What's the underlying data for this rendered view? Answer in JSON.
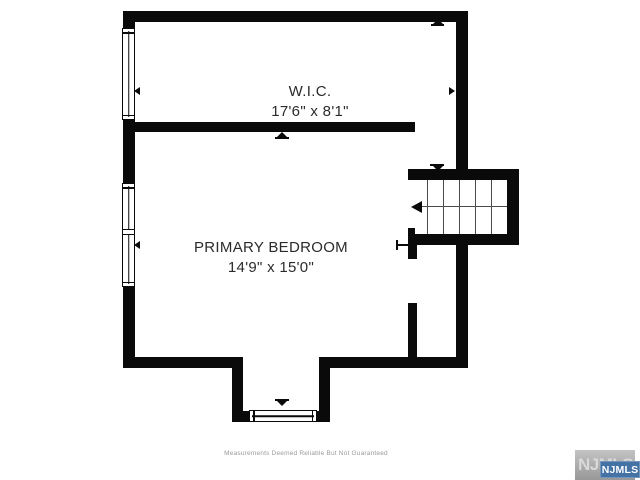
{
  "floorplan": {
    "rooms": [
      {
        "name": "W.I.C.",
        "dimensions": "17'6\" x 8'1\""
      },
      {
        "name": "PRIMARY BEDROOM",
        "dimensions": "14'9\" x 15'0\""
      }
    ],
    "stairs": {
      "tread_count": 6,
      "direction_arrow": "left"
    },
    "windows": [
      "wic-left-window",
      "bedroom-left-double-window",
      "bay-bottom-window"
    ]
  },
  "footer": {
    "disclaimer": "Measurements Deemed Reliable But Not Guaranteed"
  },
  "branding": {
    "watermark": "NJMLS",
    "badge": "NJMLS",
    "badge_color": "#4472a5",
    "watermark_bg": "#a9a9a9"
  },
  "colors": {
    "wall": "#0a0a0a",
    "background": "#ffffff",
    "label_text": "#2b2b2b",
    "disclaimer_text": "#9a9a9a"
  }
}
